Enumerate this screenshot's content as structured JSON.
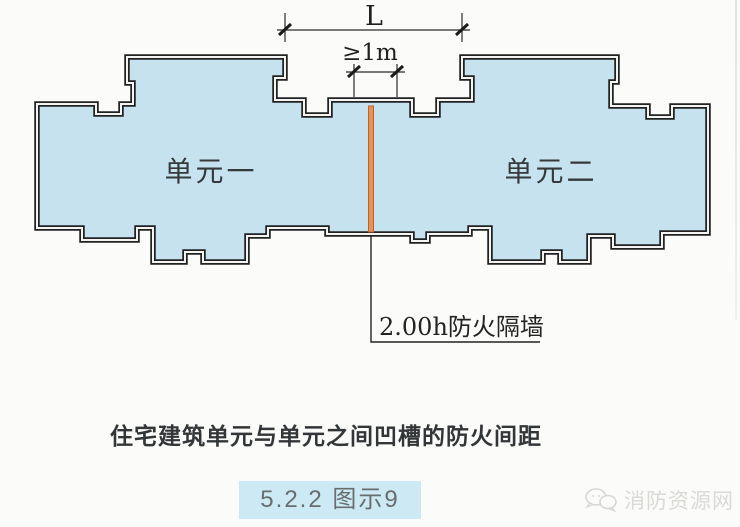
{
  "colors": {
    "plan_fill": "#c6e2ee",
    "wall_stroke": "#222222",
    "wall_core": "#f4f5f2",
    "firewall_fill": "#e6935a",
    "firewall_edge": "#c2602a",
    "badge_bg": "#cdeaf4"
  },
  "diagram": {
    "dimension_L": {
      "label": "L"
    },
    "dimension_min": {
      "label": "≥1m"
    },
    "unit_left": {
      "label": "单元一"
    },
    "unit_right": {
      "label": "单元二"
    },
    "firewall_label": "2.00h防火隔墙"
  },
  "caption": "住宅建筑单元与单元之间凹槽的防火间距",
  "figure_badge": "5.2.2 图示9",
  "watermark": {
    "text": "消防资源网",
    "icon": "wechat-icon"
  }
}
